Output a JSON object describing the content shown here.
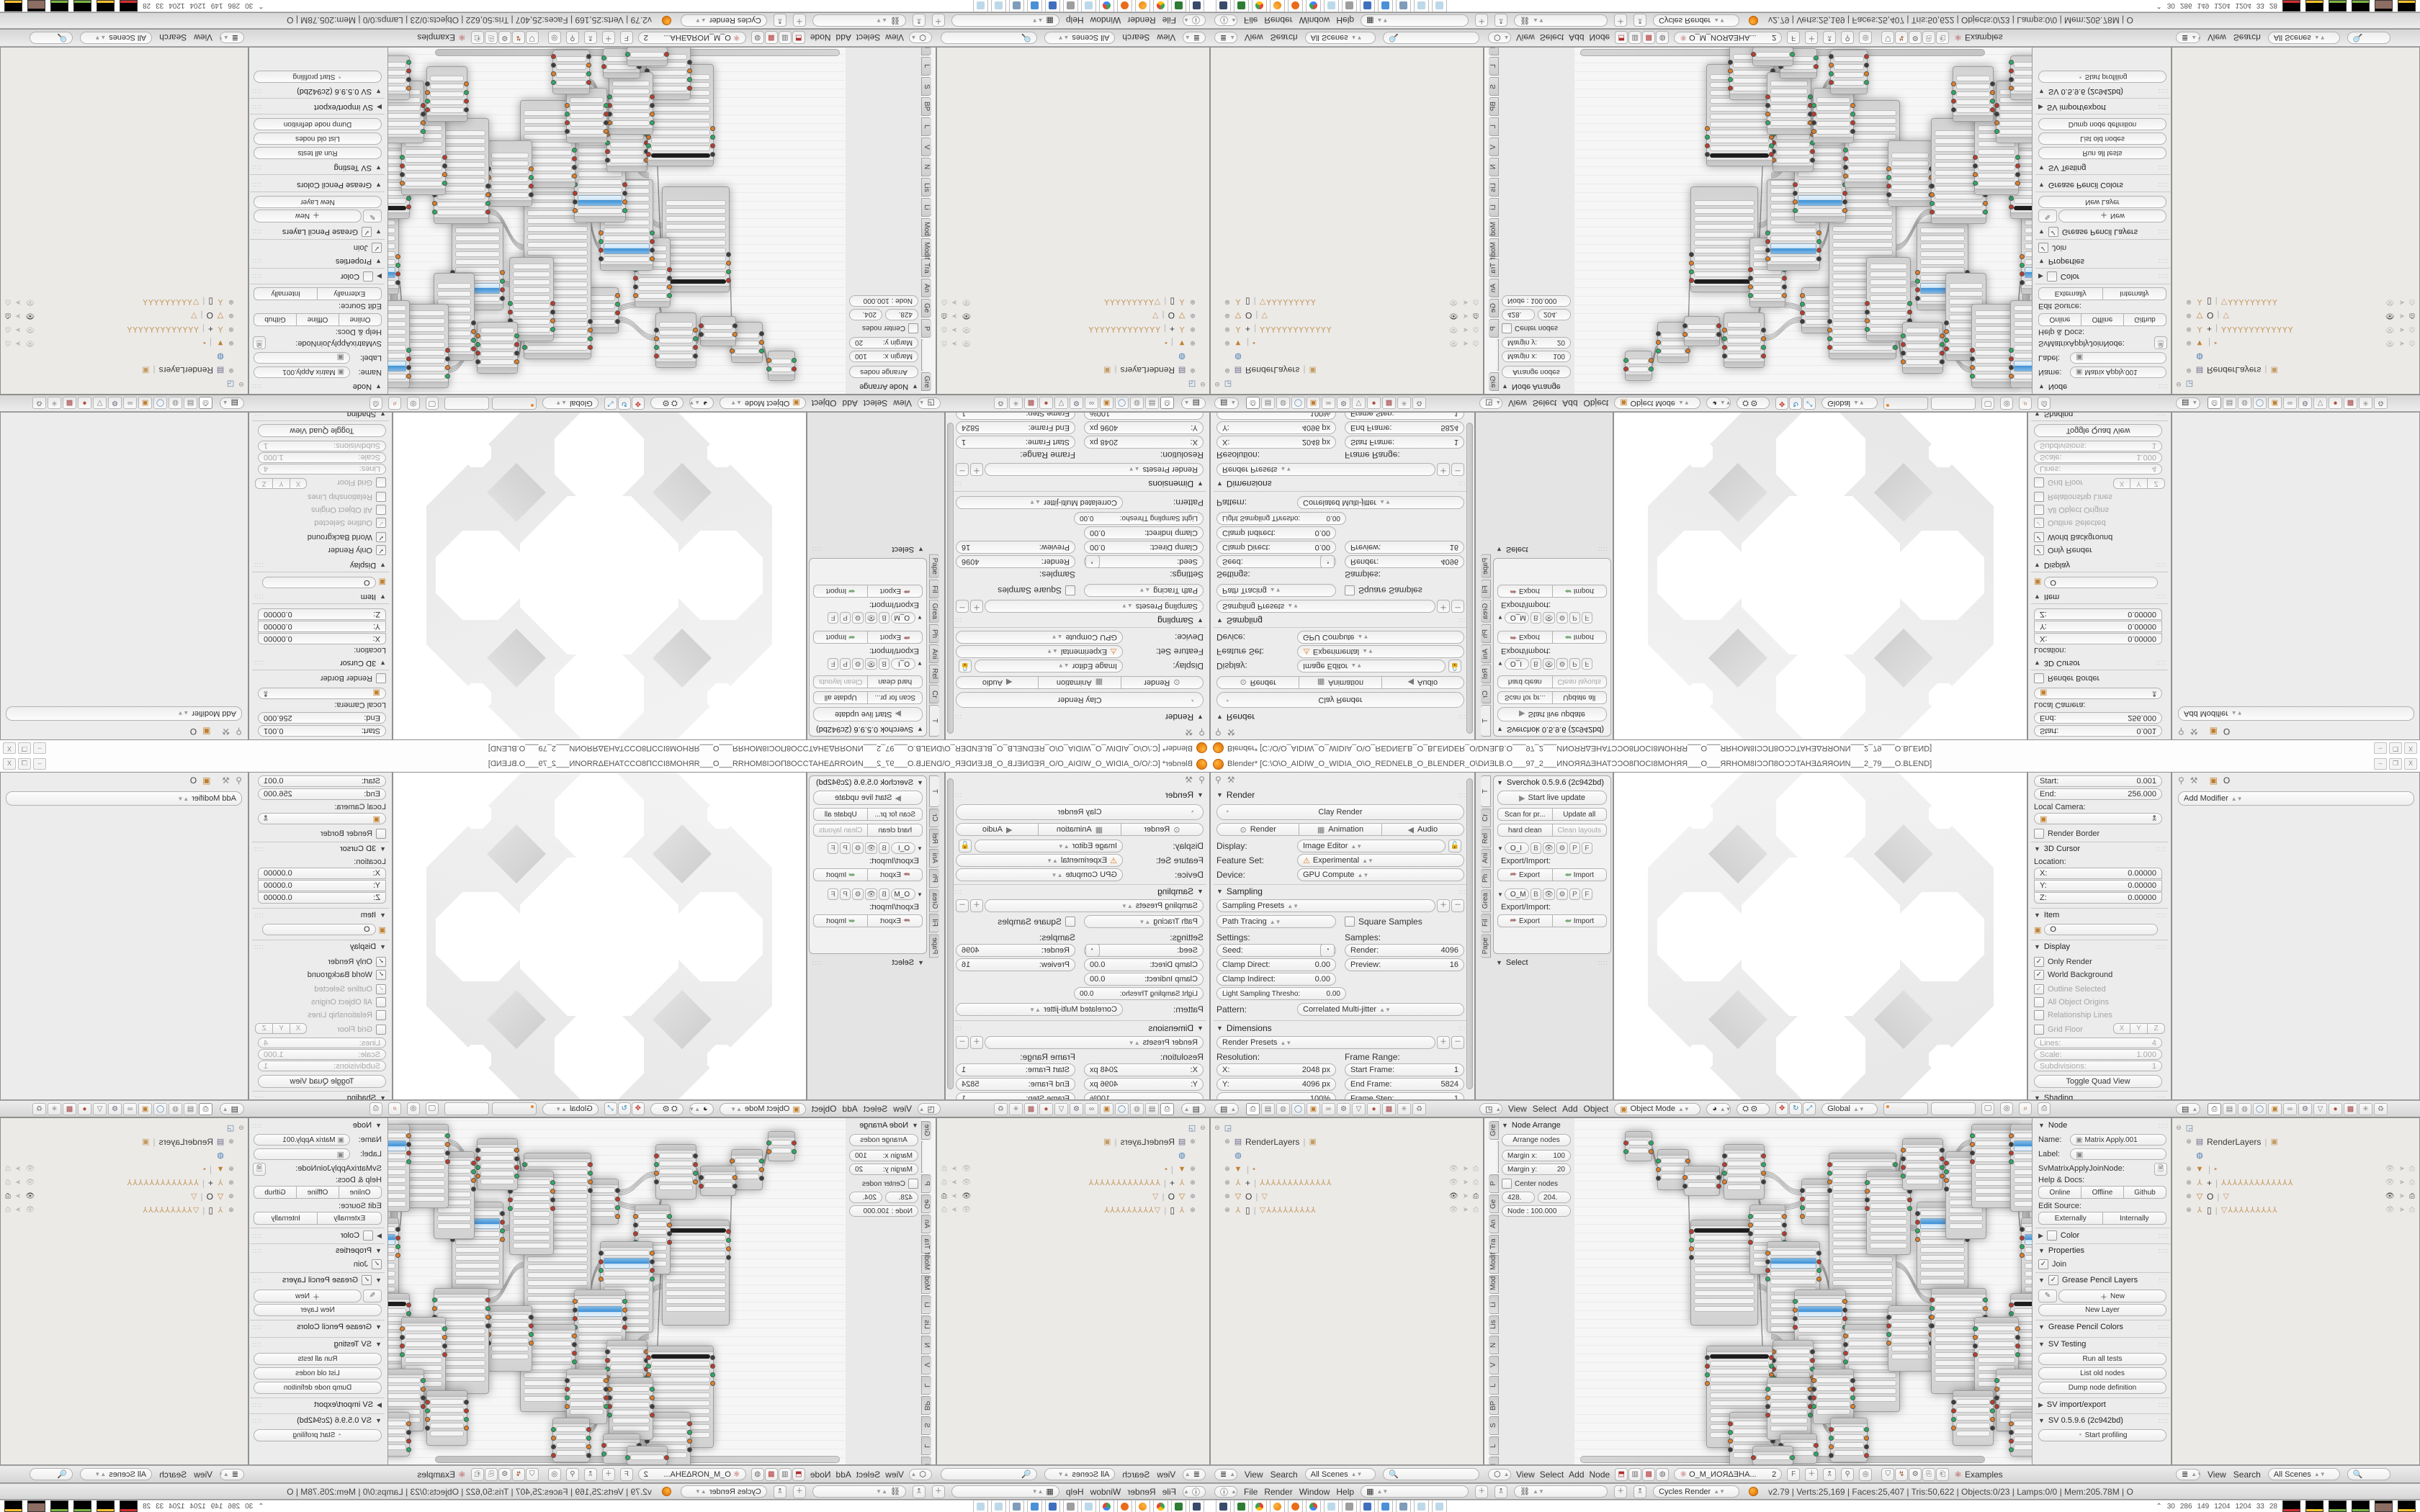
{
  "window": {
    "title": "Blender* [C:\\O\\O_AIDIW_O_WIDIA_O\\O_REDNELB_O_BLENDER_O\\DИƎLB.O___97_2___ИNOЯЯΔƎHATƆƆO8ПOCI8MOHЯЯ___O___ЯRHOM8IƆƆП8OƆƆTAHƎΔЯЯOИN___2_79___O.BLEND]",
    "btn_min": "–",
    "btn_restore": "❐",
    "btn_close": "X"
  },
  "props_render": {
    "panel_render": "Render",
    "clay_render": "Clay Render",
    "render": "Render",
    "animation": "Animation",
    "audio": "Audio",
    "display_label": "Display:",
    "display_value": "Image Editor",
    "feature_label": "Feature Set:",
    "feature_value": "Experimental",
    "device_label": "Device:",
    "device_value": "GPU Compute",
    "panel_sampling": "Sampling",
    "sampling_presets": "Sampling Presets",
    "path_tracing": "Path Tracing",
    "square_samples": "Square Samples",
    "settings": "Settings:",
    "samples": "Samples:",
    "seed_l": "Seed:",
    "seed_v": "0",
    "clampd_l": "Clamp Direct:",
    "clampd_v": "0.00",
    "clampi_l": "Clamp Indirect:",
    "clampi_v": "0.00",
    "light_l": "Light Sampling Thresho:",
    "light_v": "0.00",
    "render_l": "Render:",
    "render_v": "4096",
    "preview_l": "Preview:",
    "preview_v": "16",
    "pattern_l": "Pattern:",
    "pattern_v": "Correlated Multi-jitter",
    "panel_dimensions": "Dimensions",
    "render_presets": "Render Presets",
    "resolution": "Resolution:",
    "frame_range": "Frame Range:",
    "res_x_l": "X:",
    "res_x_v": "2048 px",
    "res_y_l": "Y:",
    "res_y_v": "4096 px",
    "res_pct": "100%",
    "fr_start_l": "Start Frame:",
    "fr_start_v": "1",
    "fr_end_l": "End Frame:",
    "fr_end_v": "5824",
    "fr_step_l": "Frame Step:",
    "fr_step_v": "1",
    "aspect": "Aspect Ratio:",
    "frame_rate": "Frame Rate:"
  },
  "sverchok": {
    "title": "Sverchok 0.5.9.6 (2c942bd)",
    "start_live": "Start live update",
    "scan": "Scan for pr...",
    "update_all": "Update all",
    "hard_clean": "hard clean",
    "clean_layouts": "Clean layouts",
    "tree1": "O_I",
    "tree2": "O_M",
    "b": "B",
    "p": "P",
    "f": "F",
    "exp_imp": "Export/Import:",
    "export": "Export",
    "import": "Import",
    "select_panel": "Select",
    "tabs": [
      "T",
      "Cr",
      "Rel",
      "Ani",
      "Ph",
      "Grea",
      "Fil",
      "Pape"
    ]
  },
  "view3d_npanel": {
    "start_l": "Start:",
    "start_v": "0.001",
    "end_l": "End:",
    "end_v": "256.000",
    "local_camera": "Local Camera:",
    "render_border": "Render Border",
    "cursor3d": "3D Cursor",
    "location": "Location:",
    "x_l": "X:",
    "x_v": "0.00000",
    "y_l": "Y:",
    "y_v": "0.00000",
    "z_l": "Z:",
    "z_v": "0.00000",
    "item": "Item",
    "item_name": "O",
    "display": "Display",
    "only_render": "Only Render",
    "world_bg": "World Background",
    "outline_sel": "Outline Selected",
    "all_origins": "All Object Origins",
    "rel_lines": "Relationship Lines",
    "grid_floor": "Grid Floor",
    "gx": "X",
    "gy": "Y",
    "gz": "Z",
    "lines_l": "Lines:",
    "lines_v": "4",
    "scale_l": "Scale:",
    "scale_v": "1.000",
    "subd_l": "Subdivisions:",
    "subd_v": "1",
    "toggle_quad": "Toggle Quad View",
    "shading": "Shading"
  },
  "props_modifier": {
    "breadcrumb": "O",
    "add_modifier": "Add Modifier"
  },
  "headers": {
    "view": "View",
    "select": "Select",
    "search": "Search",
    "add": "Add",
    "object": "Object",
    "node": "Node",
    "object_mode": "Object Mode",
    "global": "Global",
    "all_scenes": "All Scenes",
    "tree_name": "O_M_ИOЯΔƎHA...",
    "tree_users": "2",
    "tree_fake": "F",
    "examples": "Examples"
  },
  "node_tpanel": {
    "title": "Node Arrange",
    "arrange": "Arrange nodes",
    "margin_x_l": "Margin x:",
    "margin_x_v": "100",
    "margin_y_l": "Margin y:",
    "margin_y_v": "20",
    "center_nodes": "Center nodes",
    "num1": "428.",
    "num2": "204.",
    "node_slider": "Node : 100.000",
    "tabs": [
      "Gre",
      "",
      "P",
      "Ge",
      "An",
      "Tra",
      "Modif",
      "Mod",
      "Li",
      "Lis",
      "N",
      "V",
      "L",
      "BP",
      "S",
      "L",
      "N",
      "Bet",
      "G"
    ]
  },
  "node_npanel": {
    "panel_node": "Node",
    "name_l": "Name:",
    "name_v": "Matrix Apply.001",
    "label_l": "Label:",
    "idname": "SvMatrixApplyJoinNode:",
    "help_docs": "Help & Docs:",
    "online": "Online",
    "offline": "Offline",
    "github": "Github",
    "edit_source": "Edit Source:",
    "externally": "Externally",
    "internally": "Internally",
    "color": "Color",
    "properties": "Properties",
    "join": "Join",
    "gp_layers": "Grease Pencil Layers",
    "new": "New",
    "new_layer": "New Layer",
    "gp_colors": "Grease Pencil Colors",
    "sv_testing": "SV Testing",
    "run_tests": "Run all tests",
    "list_old": "List old nodes",
    "dump_def": "Dump node definition",
    "sv_ie": "SV import/export",
    "sv_ver": "SV 0.5.9.6 (2c942bd)",
    "profiling": "Start profiling"
  },
  "outliner": {
    "rows": [
      {
        "exp": "⊖",
        "icon": "scene",
        "label": "",
        "trail": "",
        "tog": ""
      },
      {
        "exp": "⊕",
        "icon": "rlayer",
        "label": "RenderLayers",
        "trail": "▣",
        "tog": ""
      },
      {
        "exp": "",
        "icon": "world",
        "label": "",
        "trail": "",
        "tog": ""
      },
      {
        "exp": "⊕",
        "icon": "mesh",
        "label": "",
        "trail": "▪",
        "tog": "dim"
      },
      {
        "exp": "⊕",
        "icon": "arm",
        "label": "+",
        "trail": "⅄⅄⅄⅄⅄⅄⅄⅄⅄⅄⅄⅄⅄",
        "tog": "dim"
      },
      {
        "exp": "⊕",
        "icon": "cone",
        "label": "O",
        "trail": "▽",
        "tog": "on"
      },
      {
        "exp": "⊕",
        "icon": "arm",
        "label": "▯",
        "trail": "▽⅄⅄⅄⅄⅄⅄⅄⅄⅄",
        "tog": "dim"
      }
    ]
  },
  "info_bar": {
    "file": "File",
    "render": "Render",
    "window": "Window",
    "help": "Help",
    "engine": "Cycles Render",
    "stats": "v2.79 | Verts:25,169 | Faces:25,407 | Tris:50,622 | Objects:0/23 | Lamps:0/0 | Mem:205.78M | O"
  },
  "taskbar": {
    "icons": [
      "screenshot",
      "recorder",
      "chrome",
      "blender",
      "openshot",
      "chrome2",
      "notepad",
      "speaker",
      "floppy64",
      "imageviewer",
      "calculator",
      "notepad2",
      "notepad3"
    ],
    "tray_chevron": "⌃",
    "tray_numbers": [
      "30",
      "286",
      "149",
      "1204",
      "1204",
      "33",
      "28"
    ]
  },
  "graph": {
    "nodes": [
      [
        70,
        18,
        36,
        40,
        "p"
      ],
      [
        115,
        43,
        42,
        55,
        "p"
      ],
      [
        152,
        66,
        48,
        40,
        "p"
      ],
      [
        207,
        36,
        55,
        75,
        "p"
      ],
      [
        161,
        141,
        92,
        145,
        "d"
      ],
      [
        243,
        120,
        48,
        95,
        "p"
      ],
      [
        267,
        171,
        72,
        125,
        "b"
      ],
      [
        315,
        84,
        46,
        62,
        "p"
      ],
      [
        353,
        48,
        92,
        255,
        "t"
      ],
      [
        405,
        73,
        60,
        115,
        "p"
      ],
      [
        455,
        28,
        55,
        70,
        "p"
      ],
      [
        475,
        116,
        70,
        120,
        "b"
      ],
      [
        515,
        46,
        55,
        120,
        "p"
      ],
      [
        551,
        8,
        60,
        115,
        "p"
      ],
      [
        605,
        8,
        80,
        120,
        "b"
      ],
      [
        620,
        138,
        70,
        110,
        "b"
      ],
      [
        605,
        243,
        70,
        130,
        "d"
      ],
      [
        305,
        238,
        70,
        135,
        "b"
      ],
      [
        375,
        286,
        75,
        120,
        "p"
      ],
      [
        435,
        260,
        60,
        90,
        "p"
      ],
      [
        495,
        236,
        75,
        145,
        "p"
      ],
      [
        555,
        276,
        60,
        110,
        "p"
      ],
      [
        275,
        308,
        55,
        100,
        "p"
      ],
      [
        183,
        316,
        90,
        140,
        "d"
      ],
      [
        215,
        408,
        60,
        75,
        "p"
      ],
      [
        267,
        360,
        60,
        85,
        "p"
      ],
      [
        331,
        348,
        55,
        75,
        "p"
      ],
      [
        285,
        438,
        50,
        40,
        "p"
      ],
      [
        355,
        416,
        50,
        60,
        "p"
      ],
      [
        585,
        348,
        55,
        85,
        "p"
      ],
      [
        605,
        408,
        50,
        60,
        "p"
      ],
      [
        525,
        378,
        55,
        75,
        "p"
      ],
      [
        247,
        455,
        55,
        25,
        "p"
      ]
    ],
    "links": [
      [
        106,
        38,
        115,
        60
      ],
      [
        157,
        86,
        161,
        160
      ],
      [
        200,
        86,
        207,
        70
      ],
      [
        255,
        110,
        267,
        180
      ],
      [
        262,
        74,
        315,
        100
      ],
      [
        291,
        120,
        353,
        100
      ],
      [
        361,
        60,
        405,
        90
      ],
      [
        445,
        100,
        455,
        50
      ],
      [
        445,
        140,
        475,
        150
      ],
      [
        465,
        93,
        515,
        80
      ],
      [
        510,
        60,
        551,
        30
      ],
      [
        570,
        30,
        605,
        40
      ],
      [
        611,
        50,
        620,
        150
      ],
      [
        445,
        200,
        495,
        250
      ],
      [
        339,
        200,
        375,
        300
      ],
      [
        253,
        230,
        305,
        270
      ],
      [
        273,
        300,
        331,
        370
      ],
      [
        377,
        330,
        435,
        290
      ],
      [
        445,
        290,
        495,
        300
      ],
      [
        570,
        310,
        585,
        360
      ],
      [
        555,
        330,
        605,
        420
      ],
      [
        253,
        190,
        267,
        380
      ],
      [
        327,
        380,
        355,
        430
      ],
      [
        245,
        430,
        247,
        462
      ]
    ]
  },
  "lattice": {
    "holes": [
      [
        177,
        118,
        220
      ],
      [
        225,
        1,
        124
      ],
      [
        225,
        331,
        124
      ],
      [
        60,
        166,
        124
      ],
      [
        390,
        166,
        124
      ],
      [
        97,
        38,
        40
      ],
      [
        437,
        38,
        40
      ],
      [
        97,
        378,
        40
      ],
      [
        437,
        378,
        40
      ]
    ],
    "diamonds": [
      [
        143,
        84,
        58
      ],
      [
        373,
        84,
        58
      ],
      [
        143,
        314,
        58
      ],
      [
        373,
        314,
        58
      ]
    ]
  }
}
